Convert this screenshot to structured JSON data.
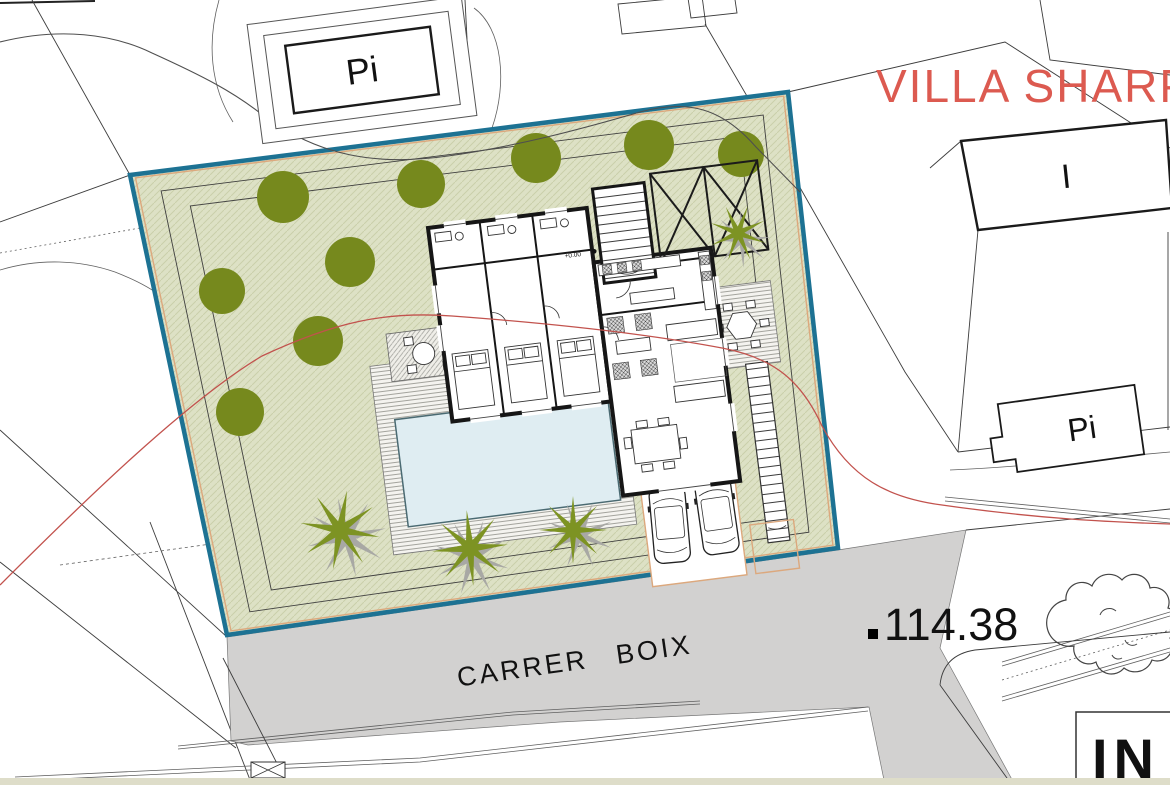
{
  "title": {
    "text": "VILLA SHARPE"
  },
  "labels": {
    "street": "CARRER BOIX",
    "elevation": "114.38",
    "level_marker": "+0.00",
    "building_pi_top": "Pi",
    "building_i_right": "I",
    "building_pi_right": "Pi",
    "building_in_bottom": "IN"
  },
  "colors": {
    "title_red": "#dc5a50",
    "plot_fill": "#dde1c5",
    "plot_hatch": "#b9c194",
    "plot_border_blue": "#1d7293",
    "plot_inner_peach": "#dca87d",
    "road_gray": "#d2d1d0",
    "tree_green": "#76891d",
    "palm_green": "#7d9323",
    "palm_shadow": "#a8a8a4",
    "contour_red": "#c2524d",
    "wall_black": "#161616",
    "pool_blue": "#dfedf2",
    "bottom_bar": "#deddc9"
  },
  "landscape": {
    "trees": [
      {
        "x": 283,
        "y": 197,
        "r": 26
      },
      {
        "x": 421,
        "y": 184,
        "r": 24
      },
      {
        "x": 536,
        "y": 158,
        "r": 25
      },
      {
        "x": 649,
        "y": 145,
        "r": 25
      },
      {
        "x": 741,
        "y": 154,
        "r": 23
      },
      {
        "x": 350,
        "y": 262,
        "r": 25
      },
      {
        "x": 222,
        "y": 291,
        "r": 23
      },
      {
        "x": 318,
        "y": 341,
        "r": 25
      },
      {
        "x": 240,
        "y": 412,
        "r": 24
      }
    ],
    "palms": [
      {
        "x": 340,
        "y": 530,
        "scale": 1,
        "rotate": 10
      },
      {
        "x": 470,
        "y": 548,
        "scale": 0.95,
        "rotate": 40
      },
      {
        "x": 573,
        "y": 530,
        "scale": 0.85,
        "rotate": 0
      },
      {
        "x": 738,
        "y": 233,
        "scale": 0.72,
        "rotate": 20
      }
    ]
  }
}
